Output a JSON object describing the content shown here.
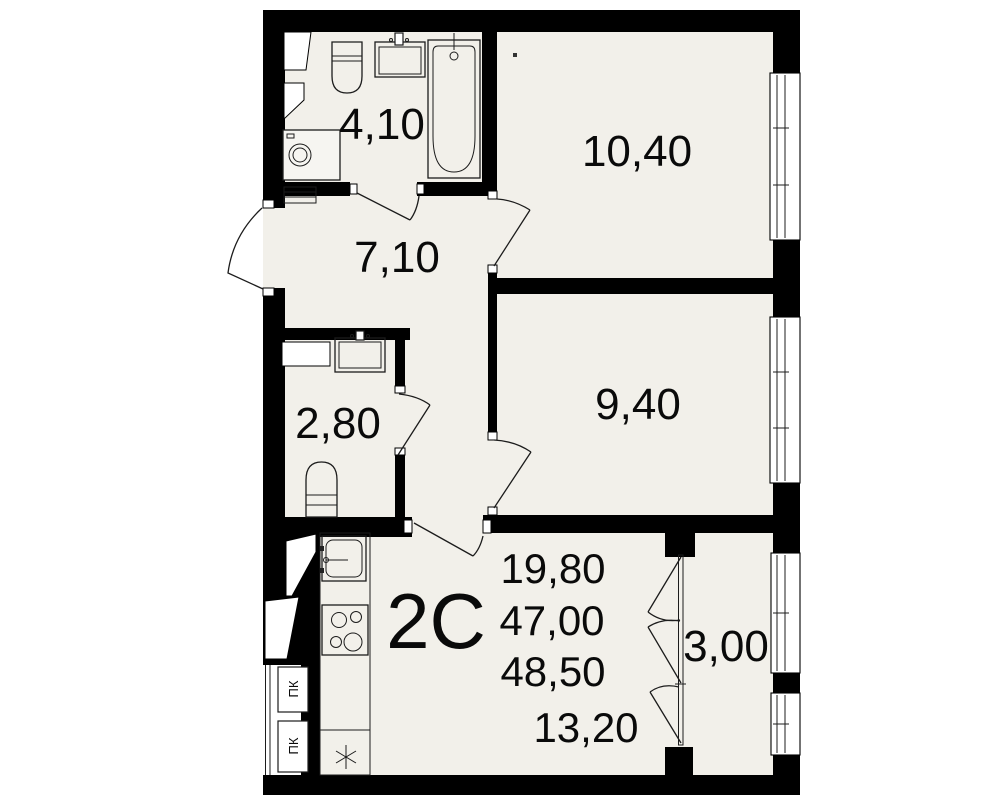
{
  "rooms": {
    "bathroom_area": "4,10",
    "bedroom1_area": "10,40",
    "hallway_area": "7,10",
    "wc_area": "2,80",
    "bedroom2_area": "9,40",
    "kitchen_living_area": "13,20",
    "balcony_area": "3,00"
  },
  "apartment": {
    "type_label": "2С",
    "living_area": "19,80",
    "total_area": "47,00",
    "total_area_with_balcony": "48,50"
  },
  "utility": {
    "fire_cabinet_1": "ПК",
    "fire_cabinet_2": "ПК"
  },
  "colors": {
    "wall": "#000000",
    "floor": "#f2f0ea",
    "line": "#1c1c1c",
    "background": "#ffffff",
    "text": "#0a0a0a"
  }
}
